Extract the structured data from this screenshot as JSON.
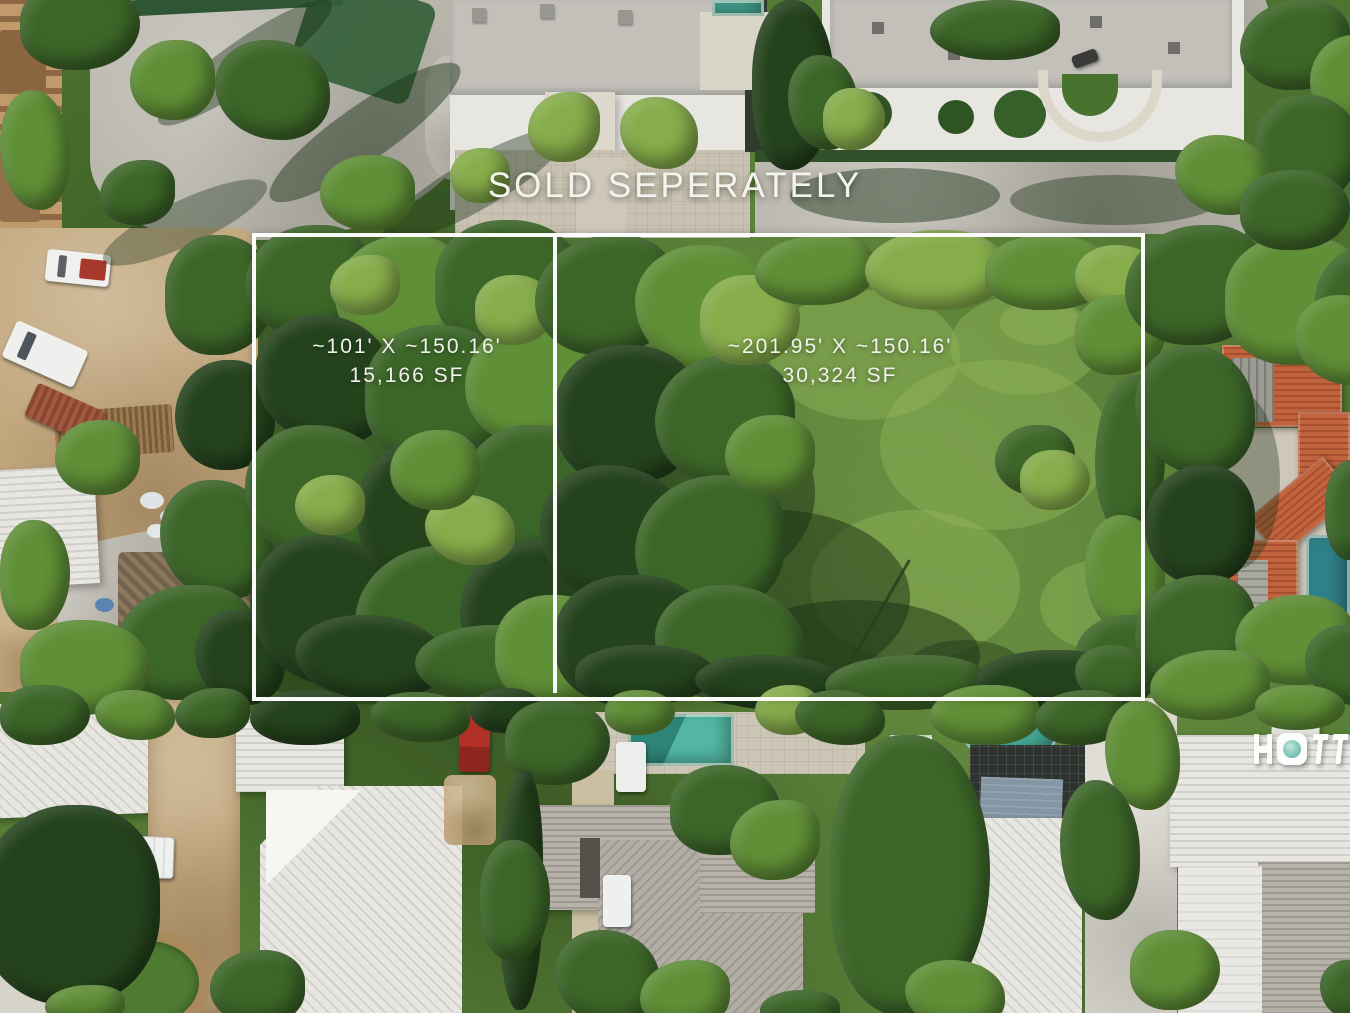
{
  "overlay": {
    "title": "SOLD SEPERATELY",
    "parcels": [
      {
        "dimensions": "~101' X ~150.16'",
        "area": "15,166 SF"
      },
      {
        "dimensions": "~201.95' X ~150.16'",
        "area": "30,324 SF"
      }
    ],
    "outline_color": "#ffffff",
    "text_color": "#f1f2ec"
  },
  "watermark": {
    "visible_letters": "HOTT",
    "note_is_partial": "cut off at right edge of photo",
    "accent": "#45a795"
  },
  "palette": {
    "grass": "#6f9a45",
    "grass_light": "#93b65c",
    "tree_dark": "#24431c",
    "tree_mid": "#3c6628",
    "tree_light": "#5f8f36",
    "tree_bright": "#86ad4a",
    "pavement": "#b8b5ab",
    "dirt": "#c3a87f",
    "roof_white": "#e7e6e1",
    "roof_gray": "#c2c0b9",
    "roof_terracotta": "#c1643e",
    "pool_teal": "#45a795",
    "pool_blue": "#1e4f68",
    "outline": "#ffffff"
  }
}
